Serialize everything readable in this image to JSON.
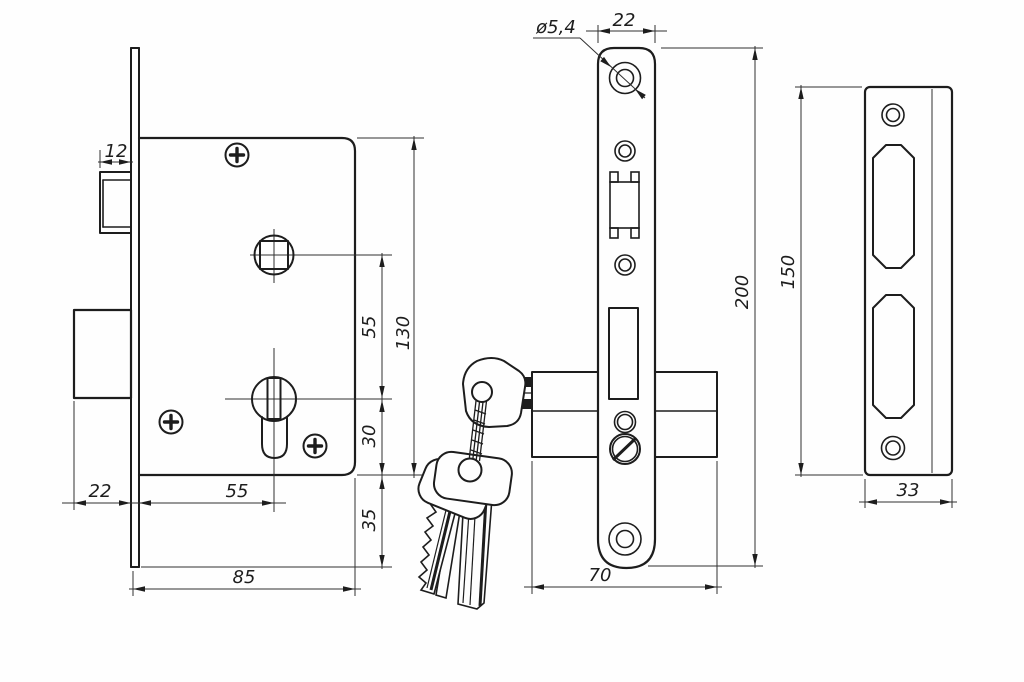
{
  "drawing": {
    "subject": "mortise-lock-technical-drawing",
    "colors": {
      "line": "#1d1d1d",
      "background": "#fefefe"
    }
  },
  "labels": {
    "latch_throw": "12",
    "bolt_throw": "22",
    "backset_bottom": "55",
    "body_width": "85",
    "centers_distance": "55",
    "body_height": "130",
    "cylinder_to_bottom": "30",
    "body_to_plate_bottom": "35",
    "hole_diameter": "ø5,4",
    "faceplate_width": "22",
    "faceplate_height": "200",
    "body_depth": "70",
    "strike_height": "150",
    "strike_width": "33"
  }
}
